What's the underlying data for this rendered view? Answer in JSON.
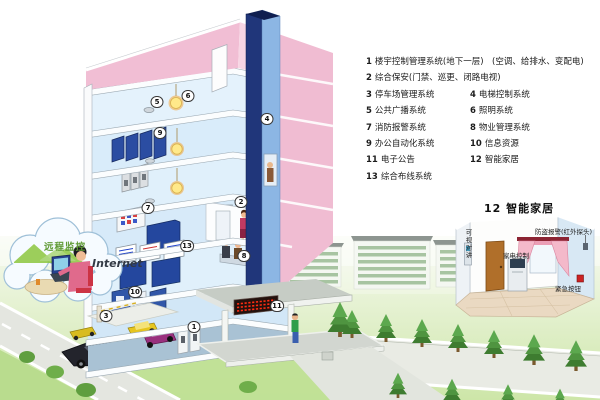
{
  "diagram": {
    "legend": {
      "items": [
        {
          "num": "1",
          "label": "楼宇控制管理系统(地下一层)　(空调、给排水、变配电)"
        },
        {
          "num": "2",
          "label": "综合保安(门禁、巡更、闭路电视)"
        },
        {
          "num": "3",
          "label": "停车场管理系统"
        },
        {
          "num": "4",
          "label": "电梯控制系统"
        },
        {
          "num": "5",
          "label": "公共广播系统"
        },
        {
          "num": "6",
          "label": "照明系统"
        },
        {
          "num": "7",
          "label": "消防报警系统"
        },
        {
          "num": "8",
          "label": "物业管理系统"
        },
        {
          "num": "9",
          "label": "办公自动化系统"
        },
        {
          "num": "10",
          "label": "信息资源"
        },
        {
          "num": "11",
          "label": "电子公告"
        },
        {
          "num": "12",
          "label": "智能家居"
        },
        {
          "num": "13",
          "label": "综合布线系统"
        }
      ]
    },
    "cloud": {
      "label": "远程监控",
      "internet": "Internet"
    },
    "smart_home": {
      "title": "12 智能家居",
      "alarm_label": "防盗报警(红外探头)",
      "appliance_label": "家电控制",
      "intercom_label": "可视对讲",
      "emergency_label": "紧急按钮"
    },
    "building_badges": [
      {
        "num": "1"
      },
      {
        "num": "2"
      },
      {
        "num": "3"
      },
      {
        "num": "4"
      },
      {
        "num": "5"
      },
      {
        "num": "6"
      },
      {
        "num": "7"
      },
      {
        "num": "8"
      },
      {
        "num": "9"
      },
      {
        "num": "10"
      },
      {
        "num": "11"
      },
      {
        "num": "13"
      }
    ],
    "colors": {
      "building_wall_pink": "#f0bcd2",
      "elevator_front": "#20367a",
      "elevator_side": "#8cb6e4",
      "interior_blue": "#dff0fb",
      "lawn_green": "#cde6a8",
      "led_red": "#ff2d12",
      "mountain_green": "#8cc63e"
    }
  }
}
